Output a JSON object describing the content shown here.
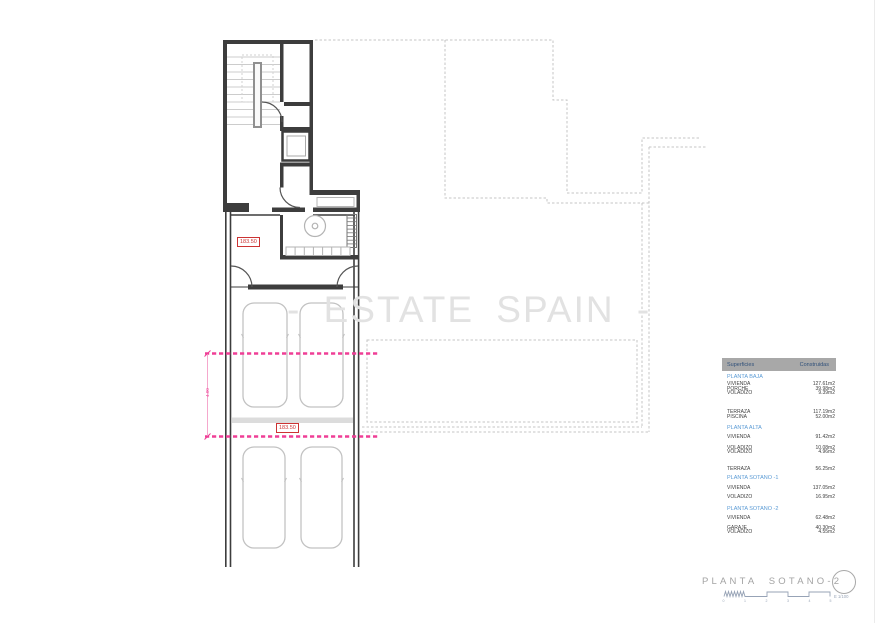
{
  "watermark": "- ESTATE SPAIN -",
  "plan": {
    "level_labels": [
      "183.50",
      "183.50"
    ],
    "dimension_label": "4.00"
  },
  "surfaces_table": {
    "header": {
      "left": "Superficies",
      "right": "Construidas"
    },
    "rows": [
      {
        "label": "PLANTA BAJA",
        "kind": "section"
      },
      {
        "label": "VIVIENDA",
        "value": "127.61m2"
      },
      {
        "label": "PORCHE",
        "value": "39.98m2"
      },
      {
        "label": "VOLADIZO",
        "value": "9.39m2"
      },
      {
        "label": "TERRAZA",
        "value": "117.19m2"
      },
      {
        "label": "PISCINA",
        "value": "52.00m2"
      },
      {
        "label": "PLANTA ALTA",
        "kind": "section"
      },
      {
        "label": "VIVIENDA",
        "value": "91.42m2"
      },
      {
        "label": "VOLADIZO",
        "value": "10.08m2"
      },
      {
        "label": "VOLADIZO",
        "value": "4.96m2"
      },
      {
        "label": "TERRAZA",
        "value": "56.25m2"
      },
      {
        "label": "PLANTA SOTANO -1",
        "kind": "section"
      },
      {
        "label": "VIVIENDA",
        "value": "137.05m2"
      },
      {
        "label": "VOLADIZO",
        "value": "16.95m2"
      },
      {
        "label": "PLANTA SOTANO -2",
        "kind": "section"
      },
      {
        "label": "VIVIENDA",
        "value": "62.48m2"
      },
      {
        "label": "GARAJE",
        "value": "40.30m2"
      },
      {
        "label": "VOLADIZO",
        "value": "4.55m2"
      }
    ]
  },
  "title_block": {
    "title": "PLANTA SOTANO-2",
    "scale_ticks": [
      "0",
      "1",
      "2",
      "3",
      "4",
      "5"
    ],
    "scale_label": "E 1/100"
  },
  "colors": {
    "accent_pink": "#ef3e96",
    "level_red": "#cc3333",
    "section_blue": "#5b9bd5",
    "table_header_bg": "#a8a8a8",
    "table_header_text": "#31517a",
    "wall_dark": "#3d3d3d",
    "ghost_grey": "#c6c6c6",
    "watermark_grey": "#e2e2e2"
  }
}
